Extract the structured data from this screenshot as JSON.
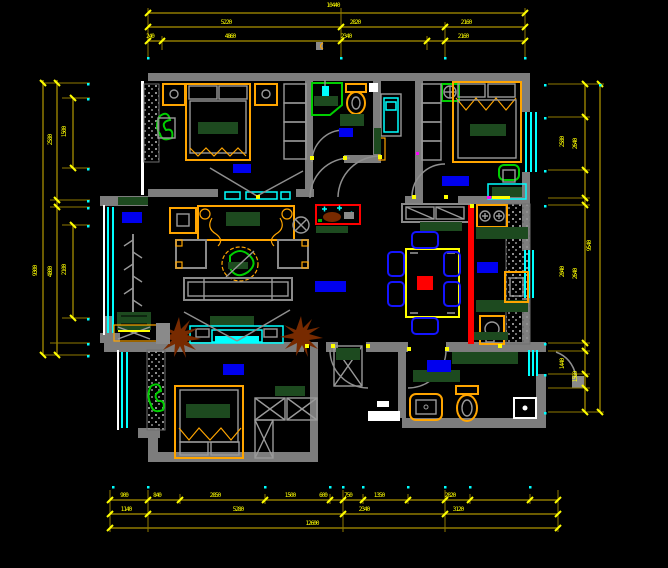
{
  "drawing": {
    "kind": "residential floor plan",
    "style": "CAD dark canvas",
    "rooms": [
      "bedroom-top-left",
      "bathroom-top",
      "bedroom-top-right",
      "living-room",
      "dining-room",
      "kitchen",
      "bedroom-bottom-left",
      "bathroom-bottom-right",
      "balcony",
      "hallway"
    ]
  },
  "colors": {
    "background": "#000000",
    "wall": "#7d7d7d",
    "dimension_text": "#ffff00",
    "dimension_line": "#8f7a00",
    "window": "#00ffff",
    "furniture": "#ffa500",
    "plant": "#00cf00",
    "textile": "#1d4a1f",
    "room_label_fill": "#0000ee",
    "accent": "#ff0000",
    "note_fill": "#ffffff",
    "dry_plant": "#772a00"
  },
  "dimension_labels": {
    "top": [
      {
        "t": "10440",
        "x": 333,
        "y": 3
      },
      {
        "t": "5220",
        "x": 226,
        "y": 20
      },
      {
        "t": "2820",
        "x": 355,
        "y": 20
      },
      {
        "t": "2160",
        "x": 466,
        "y": 20
      },
      {
        "t": "240",
        "x": 150,
        "y": 34
      },
      {
        "t": "4860",
        "x": 230,
        "y": 34
      },
      {
        "t": "2340",
        "x": 346,
        "y": 34
      },
      {
        "t": "2160",
        "x": 463,
        "y": 34
      }
    ],
    "bottom": [
      {
        "t": "900",
        "x": 124,
        "y": 493
      },
      {
        "t": "840",
        "x": 157,
        "y": 493
      },
      {
        "t": "2850",
        "x": 215,
        "y": 493
      },
      {
        "t": "1500",
        "x": 290,
        "y": 493
      },
      {
        "t": "600",
        "x": 323,
        "y": 493
      },
      {
        "t": "750",
        "x": 348,
        "y": 493
      },
      {
        "t": "1350",
        "x": 379,
        "y": 493
      },
      {
        "t": "2820",
        "x": 450,
        "y": 493
      },
      {
        "t": "1140",
        "x": 126,
        "y": 507
      },
      {
        "t": "5280",
        "x": 238,
        "y": 507
      },
      {
        "t": "2340",
        "x": 364,
        "y": 507
      },
      {
        "t": "3120",
        "x": 458,
        "y": 507
      },
      {
        "t": "12600",
        "x": 312,
        "y": 521
      }
    ],
    "left": [
      {
        "t": "9300",
        "x": 36,
        "y": 271,
        "rot": 1
      },
      {
        "t": "2580",
        "x": 51,
        "y": 140,
        "rot": 1
      },
      {
        "t": "4800",
        "x": 51,
        "y": 272,
        "rot": 1
      },
      {
        "t": "1500",
        "x": 65,
        "y": 132,
        "rot": 1
      },
      {
        "t": "2100",
        "x": 65,
        "y": 270,
        "rot": 1
      }
    ],
    "right": [
      {
        "t": "2580",
        "x": 563,
        "y": 142,
        "rot": 1
      },
      {
        "t": "2040",
        "x": 563,
        "y": 272,
        "rot": 1
      },
      {
        "t": "1440",
        "x": 563,
        "y": 364,
        "rot": 1
      },
      {
        "t": "2640",
        "x": 576,
        "y": 144,
        "rot": 1
      },
      {
        "t": "2640",
        "x": 576,
        "y": 274,
        "rot": 1
      },
      {
        "t": "1560",
        "x": 576,
        "y": 377,
        "rot": 1
      },
      {
        "t": "9540",
        "x": 590,
        "y": 246,
        "rot": 1
      }
    ]
  },
  "room_labels": [
    {
      "id": "bedroom-top-left",
      "x": 233,
      "y": 164,
      "w": 18,
      "h": 9
    },
    {
      "id": "bathroom-top",
      "x": 339,
      "y": 128,
      "w": 14,
      "h": 9
    },
    {
      "id": "bedroom-top-right",
      "x": 442,
      "y": 176,
      "w": 27,
      "h": 10
    },
    {
      "id": "living-bay",
      "x": 122,
      "y": 212,
      "w": 20,
      "h": 11
    },
    {
      "id": "hallway",
      "x": 315,
      "y": 281,
      "w": 31,
      "h": 11
    },
    {
      "id": "kitchen",
      "x": 477,
      "y": 262,
      "w": 21,
      "h": 11
    },
    {
      "id": "bedroom-bottom-left",
      "x": 223,
      "y": 364,
      "w": 21,
      "h": 11
    },
    {
      "id": "bathroom-bottom-right",
      "x": 427,
      "y": 360,
      "w": 24,
      "h": 12
    }
  ],
  "note_box": {
    "x": 368,
    "y": 411,
    "w": 32,
    "h": 10
  }
}
